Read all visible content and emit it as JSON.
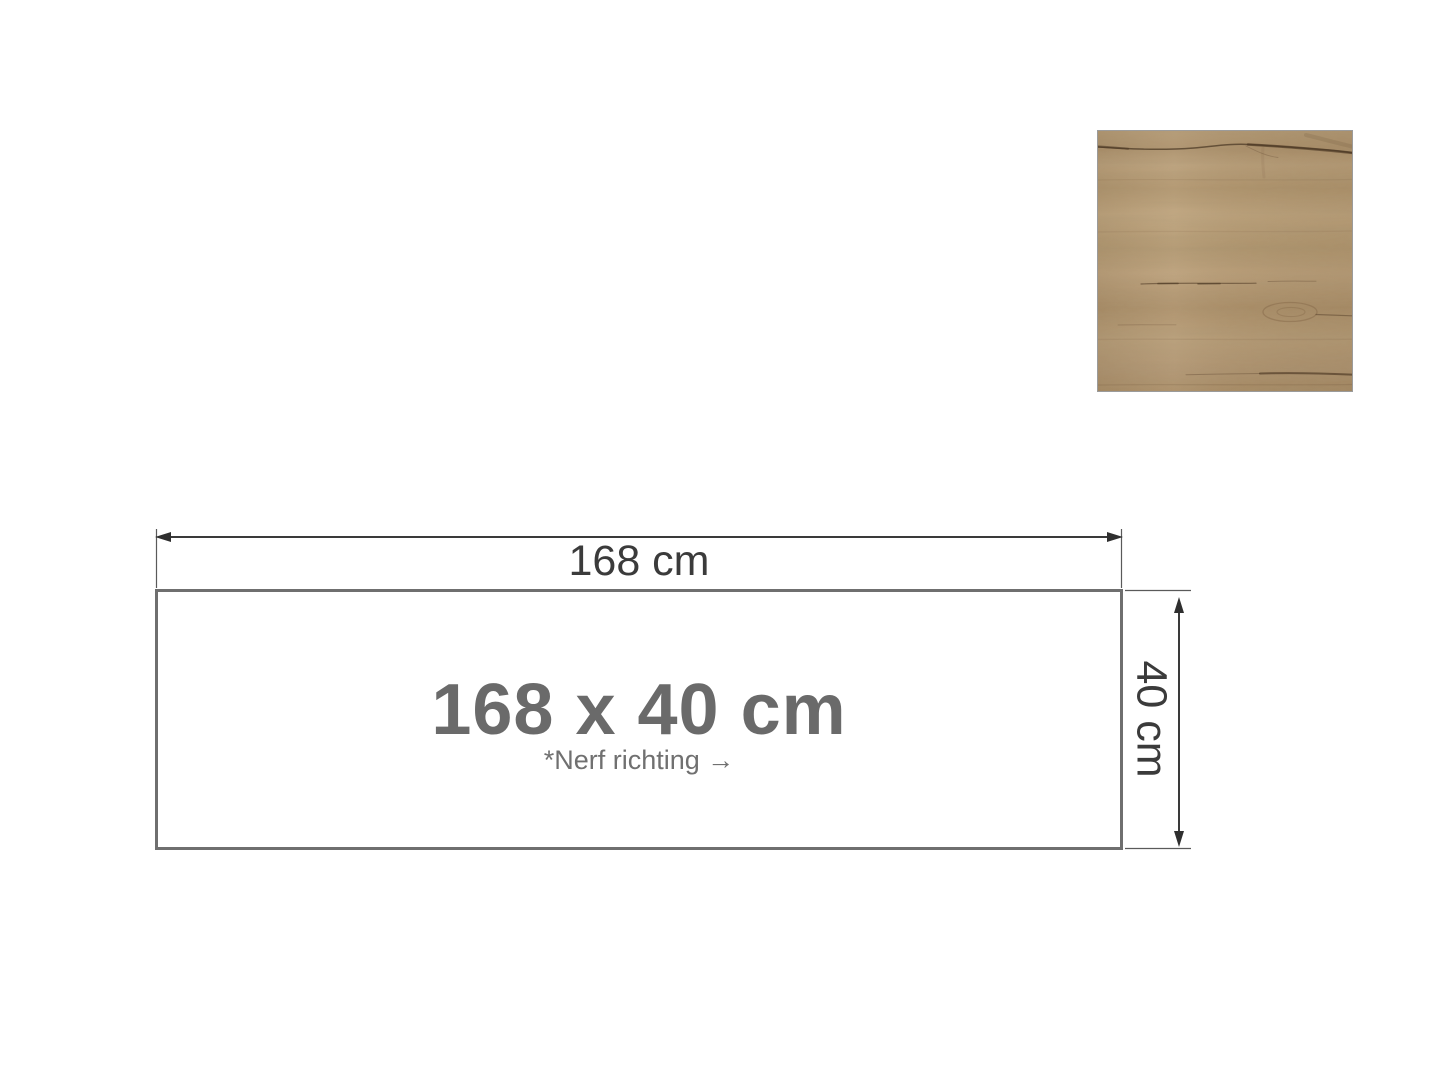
{
  "page": {
    "background_color": "#ffffff"
  },
  "texture_swatch": {
    "name": "wood-texture",
    "base_color": "#b59a74",
    "grain_color": "#6a5138",
    "crack_color": "#4a3522",
    "border_color": "#9b9b9b"
  },
  "diagram": {
    "width_label": "168 cm",
    "height_label": "40 cm",
    "size_label": "168 x 40 cm",
    "grain_note": "*Nerf richting →",
    "panel_border_color": "#6f6f6f",
    "dimension_line_color": "#3a3a3a",
    "dimension_text_color": "#3b3b3b",
    "size_label_color": "#6a6a6a",
    "grain_note_color": "#707070"
  }
}
